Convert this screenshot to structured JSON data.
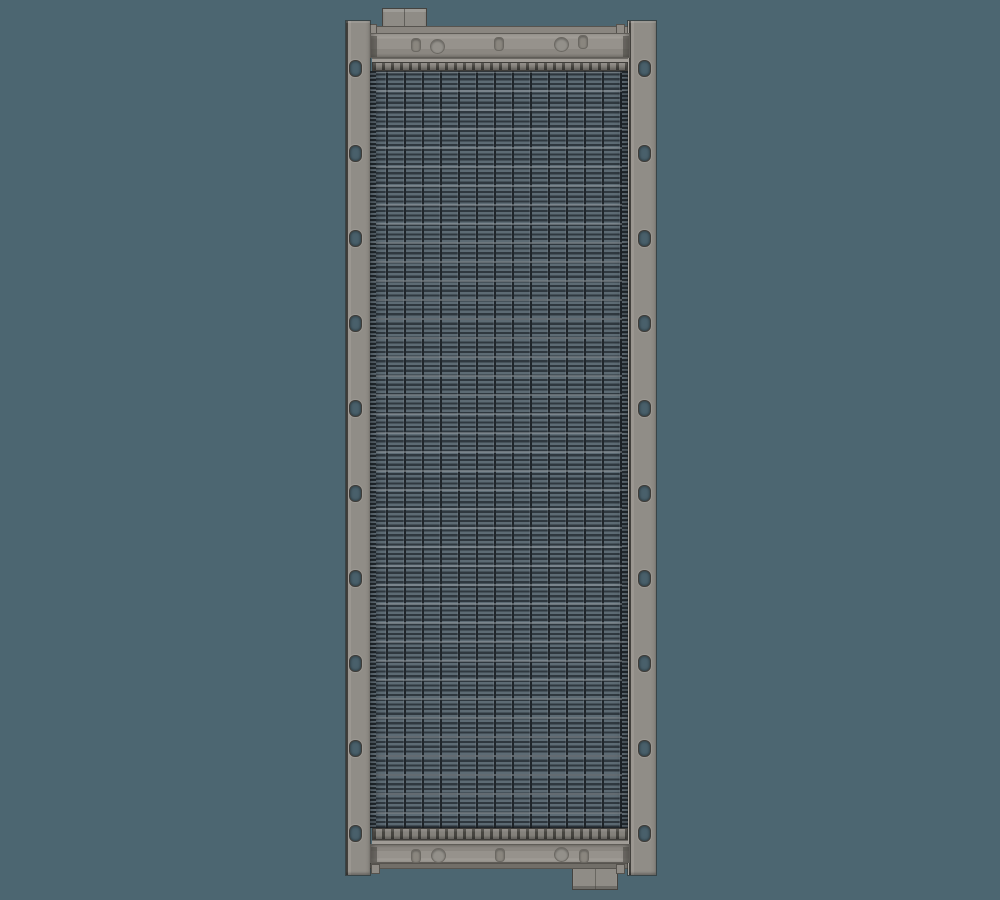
{
  "scene": {
    "type": "3d-render",
    "subject": "Vertical radiator / heat-exchanger assembly: finned tube core, top and bottom header tanks with ports, left and right mounting rails with bolt holes, one top mounting tab and one bottom mounting tab",
    "background_color": "#4C6671"
  },
  "palette": {
    "bg": "#4C6671",
    "rail-face": "#908D87",
    "rail-edge": "#44423E",
    "header-light": "#A19D97",
    "header-face": "#96928C",
    "header-dark": "#7C7973",
    "header-outline": "#5F5C57",
    "tab-face": "#8F8C86",
    "tab-outline": "#45433F",
    "strip-face": "#8A8680",
    "plate-face": "#84817B",
    "plate-dash": "#474540",
    "band-face": "#A09C96",
    "fin-light": "#5D6B74",
    "fin-dark": "#2F383F",
    "core-vline": "#20262B",
    "hole-rim": "#6B6862",
    "header-hole-fill": "#8A867F",
    "rail-hole-fill": "#49606B"
  },
  "radiator": {
    "rail_holes": {
      "count_per_rail": 10,
      "left_center_x": 354,
      "right_center_x": 643,
      "y_centers": [
        67,
        152,
        237,
        322,
        407,
        492,
        577,
        662,
        747,
        832
      ],
      "width": 11,
      "height": 15
    },
    "top_header_holes": [
      {
        "shape": "slot",
        "cx": 416,
        "cy": 45
      },
      {
        "shape": "circle",
        "cx": 437,
        "cy": 46
      },
      {
        "shape": "slot",
        "cx": 499,
        "cy": 44
      },
      {
        "shape": "circle",
        "cx": 561,
        "cy": 44
      },
      {
        "shape": "slot",
        "cx": 583,
        "cy": 42
      }
    ],
    "bottom_header_holes": [
      {
        "shape": "slot",
        "cx": 416,
        "cy": 856
      },
      {
        "shape": "circle",
        "cx": 438,
        "cy": 855
      },
      {
        "shape": "slot",
        "cx": 500,
        "cy": 855
      },
      {
        "shape": "circle",
        "cx": 561,
        "cy": 854
      },
      {
        "shape": "slot",
        "cx": 584,
        "cy": 856
      }
    ]
  }
}
